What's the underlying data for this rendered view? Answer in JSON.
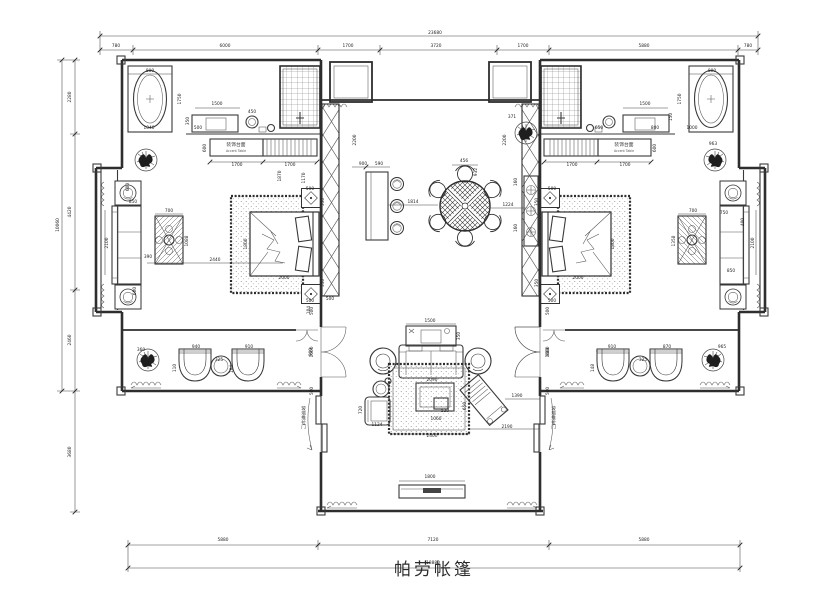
{
  "title": {
    "name": "帕劳帐篷"
  },
  "labels": {
    "accent_table_cn": "装饰台面",
    "accent_table_en": "Accent Table",
    "sliding_door": "玻璃推拉门"
  },
  "colors": {
    "ink": "#2e2e2e",
    "paper": "#ffffff",
    "hatch": "#777777"
  },
  "overall": {
    "width_mm": "23680",
    "inner_width_mm": "18880",
    "left_height_mm": "10060"
  },
  "dim_labels": [
    {
      "t": "23680",
      "x": 435,
      "y": 34
    },
    {
      "t": "780",
      "x": 116,
      "y": 47
    },
    {
      "t": "6000",
      "x": 225,
      "y": 47
    },
    {
      "t": "1700",
      "x": 348,
      "y": 47
    },
    {
      "t": "3720",
      "x": 436,
      "y": 47
    },
    {
      "t": "1700",
      "x": 523,
      "y": 47
    },
    {
      "t": "5880",
      "x": 644,
      "y": 47
    },
    {
      "t": "780",
      "x": 748,
      "y": 47
    },
    {
      "t": "5880",
      "x": 223,
      "y": 541
    },
    {
      "t": "7120",
      "x": 433,
      "y": 541
    },
    {
      "t": "5880",
      "x": 644,
      "y": 541
    },
    {
      "t": "18880",
      "x": 433,
      "y": 564
    },
    {
      "t": "2280",
      "x": 71,
      "y": 97,
      "v": 1
    },
    {
      "t": "4420",
      "x": 71,
      "y": 212,
      "v": 1
    },
    {
      "t": "2460",
      "x": 71,
      "y": 340,
      "v": 1
    },
    {
      "t": "10060",
      "x": 59,
      "y": 225,
      "v": 1
    },
    {
      "t": "3680",
      "x": 71,
      "y": 452,
      "v": 1
    },
    {
      "t": "800",
      "x": 150,
      "y": 72
    },
    {
      "t": "1750",
      "x": 181,
      "y": 99,
      "v": 1
    },
    {
      "t": "1040",
      "x": 149,
      "y": 129
    },
    {
      "t": "500",
      "x": 198,
      "y": 129
    },
    {
      "t": "350",
      "x": 189,
      "y": 121,
      "v": 1
    },
    {
      "t": "1500",
      "x": 217,
      "y": 105
    },
    {
      "t": "450",
      "x": 252,
      "y": 113
    },
    {
      "t": "600",
      "x": 206,
      "y": 148,
      "v": 1
    },
    {
      "t": "1700",
      "x": 237,
      "y": 166
    },
    {
      "t": "1700",
      "x": 290,
      "y": 166
    },
    {
      "t": "2200",
      "x": 356,
      "y": 140,
      "v": 1
    },
    {
      "t": "600",
      "x": 129,
      "y": 187,
      "v": 1
    },
    {
      "t": "850",
      "x": 133,
      "y": 203
    },
    {
      "t": "2100",
      "x": 108,
      "y": 243,
      "v": 1
    },
    {
      "t": "600",
      "x": 136,
      "y": 291,
      "v": 1
    },
    {
      "t": "700",
      "x": 169,
      "y": 212
    },
    {
      "t": "1088",
      "x": 188,
      "y": 241,
      "v": 1
    },
    {
      "t": "390",
      "x": 148,
      "y": 258
    },
    {
      "t": "2440",
      "x": 215,
      "y": 261
    },
    {
      "t": "1800",
      "x": 247,
      "y": 244,
      "v": 1
    },
    {
      "t": "2000",
      "x": 284,
      "y": 279
    },
    {
      "t": "500",
      "x": 310,
      "y": 190
    },
    {
      "t": "350",
      "x": 324,
      "y": 202,
      "v": 1
    },
    {
      "t": "350",
      "x": 324,
      "y": 283,
      "v": 1
    },
    {
      "t": "500",
      "x": 310,
      "y": 302
    },
    {
      "t": "1870",
      "x": 281,
      "y": 176,
      "v": 1
    },
    {
      "t": "1170",
      "x": 305,
      "y": 178,
      "v": 1
    },
    {
      "t": "360",
      "x": 141,
      "y": 351
    },
    {
      "t": "940",
      "x": 196,
      "y": 348
    },
    {
      "t": "110",
      "x": 176,
      "y": 368,
      "v": 1
    },
    {
      "t": "325",
      "x": 219,
      "y": 361
    },
    {
      "t": "910",
      "x": 249,
      "y": 348
    },
    {
      "t": "184",
      "x": 233,
      "y": 369,
      "v": 1
    },
    {
      "t": "900",
      "x": 312,
      "y": 352,
      "v": 1
    },
    {
      "t": "104",
      "x": 310,
      "y": 310,
      "v": 1
    },
    {
      "t": "500",
      "x": 330,
      "y": 300
    },
    {
      "t": "900",
      "x": 363,
      "y": 165
    },
    {
      "t": "590",
      "x": 379,
      "y": 165
    },
    {
      "t": "1814",
      "x": 413,
      "y": 203
    },
    {
      "t": "456",
      "x": 464,
      "y": 162
    },
    {
      "t": "932",
      "x": 477,
      "y": 172,
      "v": 1
    },
    {
      "t": "1224",
      "x": 508,
      "y": 206
    },
    {
      "t": "160",
      "x": 517,
      "y": 182,
      "v": 1
    },
    {
      "t": "160",
      "x": 517,
      "y": 228,
      "v": 1
    },
    {
      "t": "371",
      "x": 512,
      "y": 118
    },
    {
      "t": "800",
      "x": 712,
      "y": 72
    },
    {
      "t": "1750",
      "x": 681,
      "y": 99,
      "v": 1
    },
    {
      "t": "1500",
      "x": 645,
      "y": 105
    },
    {
      "t": "650",
      "x": 599,
      "y": 129
    },
    {
      "t": "800",
      "x": 655,
      "y": 129
    },
    {
      "t": "1000",
      "x": 692,
      "y": 129
    },
    {
      "t": "150",
      "x": 672,
      "y": 117,
      "v": 1
    },
    {
      "t": "1700",
      "x": 572,
      "y": 166
    },
    {
      "t": "1700",
      "x": 625,
      "y": 166
    },
    {
      "t": "600",
      "x": 656,
      "y": 148,
      "v": 1
    },
    {
      "t": "2200",
      "x": 506,
      "y": 140,
      "v": 1
    },
    {
      "t": "963",
      "x": 713,
      "y": 145
    },
    {
      "t": "500",
      "x": 552,
      "y": 190
    },
    {
      "t": "350",
      "x": 538,
      "y": 202,
      "v": 1
    },
    {
      "t": "350",
      "x": 538,
      "y": 283,
      "v": 1
    },
    {
      "t": "500",
      "x": 552,
      "y": 302
    },
    {
      "t": "2000",
      "x": 578,
      "y": 279
    },
    {
      "t": "1800",
      "x": 614,
      "y": 244,
      "v": 1
    },
    {
      "t": "700",
      "x": 693,
      "y": 212
    },
    {
      "t": "1358",
      "x": 675,
      "y": 241,
      "v": 1
    },
    {
      "t": "750",
      "x": 724,
      "y": 214
    },
    {
      "t": "2100",
      "x": 754,
      "y": 243,
      "v": 1
    },
    {
      "t": "400",
      "x": 744,
      "y": 222,
      "v": 1
    },
    {
      "t": "850",
      "x": 731,
      "y": 272
    },
    {
      "t": "910",
      "x": 612,
      "y": 348
    },
    {
      "t": "325",
      "x": 643,
      "y": 361
    },
    {
      "t": "870",
      "x": 667,
      "y": 348
    },
    {
      "t": "148",
      "x": 594,
      "y": 368,
      "v": 1
    },
    {
      "t": "965",
      "x": 722,
      "y": 348
    },
    {
      "t": "900",
      "x": 549,
      "y": 352,
      "v": 1
    },
    {
      "t": "1500",
      "x": 430,
      "y": 322
    },
    {
      "t": "350",
      "x": 460,
      "y": 336,
      "v": 1
    },
    {
      "t": "2090",
      "x": 432,
      "y": 381
    },
    {
      "t": "520",
      "x": 445,
      "y": 412
    },
    {
      "t": "1060",
      "x": 436,
      "y": 420
    },
    {
      "t": "720",
      "x": 362,
      "y": 410,
      "v": 1
    },
    {
      "t": "1124",
      "x": 377,
      "y": 426
    },
    {
      "t": "650",
      "x": 466,
      "y": 406,
      "v": 1
    },
    {
      "t": "1390",
      "x": 517,
      "y": 397
    },
    {
      "t": "2190",
      "x": 507,
      "y": 428
    },
    {
      "t": "2400",
      "x": 432,
      "y": 437
    },
    {
      "t": "1800",
      "x": 430,
      "y": 478
    },
    {
      "t": "500",
      "x": 313,
      "y": 311,
      "v": 1
    },
    {
      "t": "1600",
      "x": 313,
      "y": 352,
      "v": 1
    },
    {
      "t": "500",
      "x": 313,
      "y": 391,
      "v": 1
    },
    {
      "t": "500",
      "x": 549,
      "y": 311,
      "v": 1
    },
    {
      "t": "1600",
      "x": 549,
      "y": 352,
      "v": 1
    },
    {
      "t": "500",
      "x": 549,
      "y": 391,
      "v": 1
    }
  ]
}
